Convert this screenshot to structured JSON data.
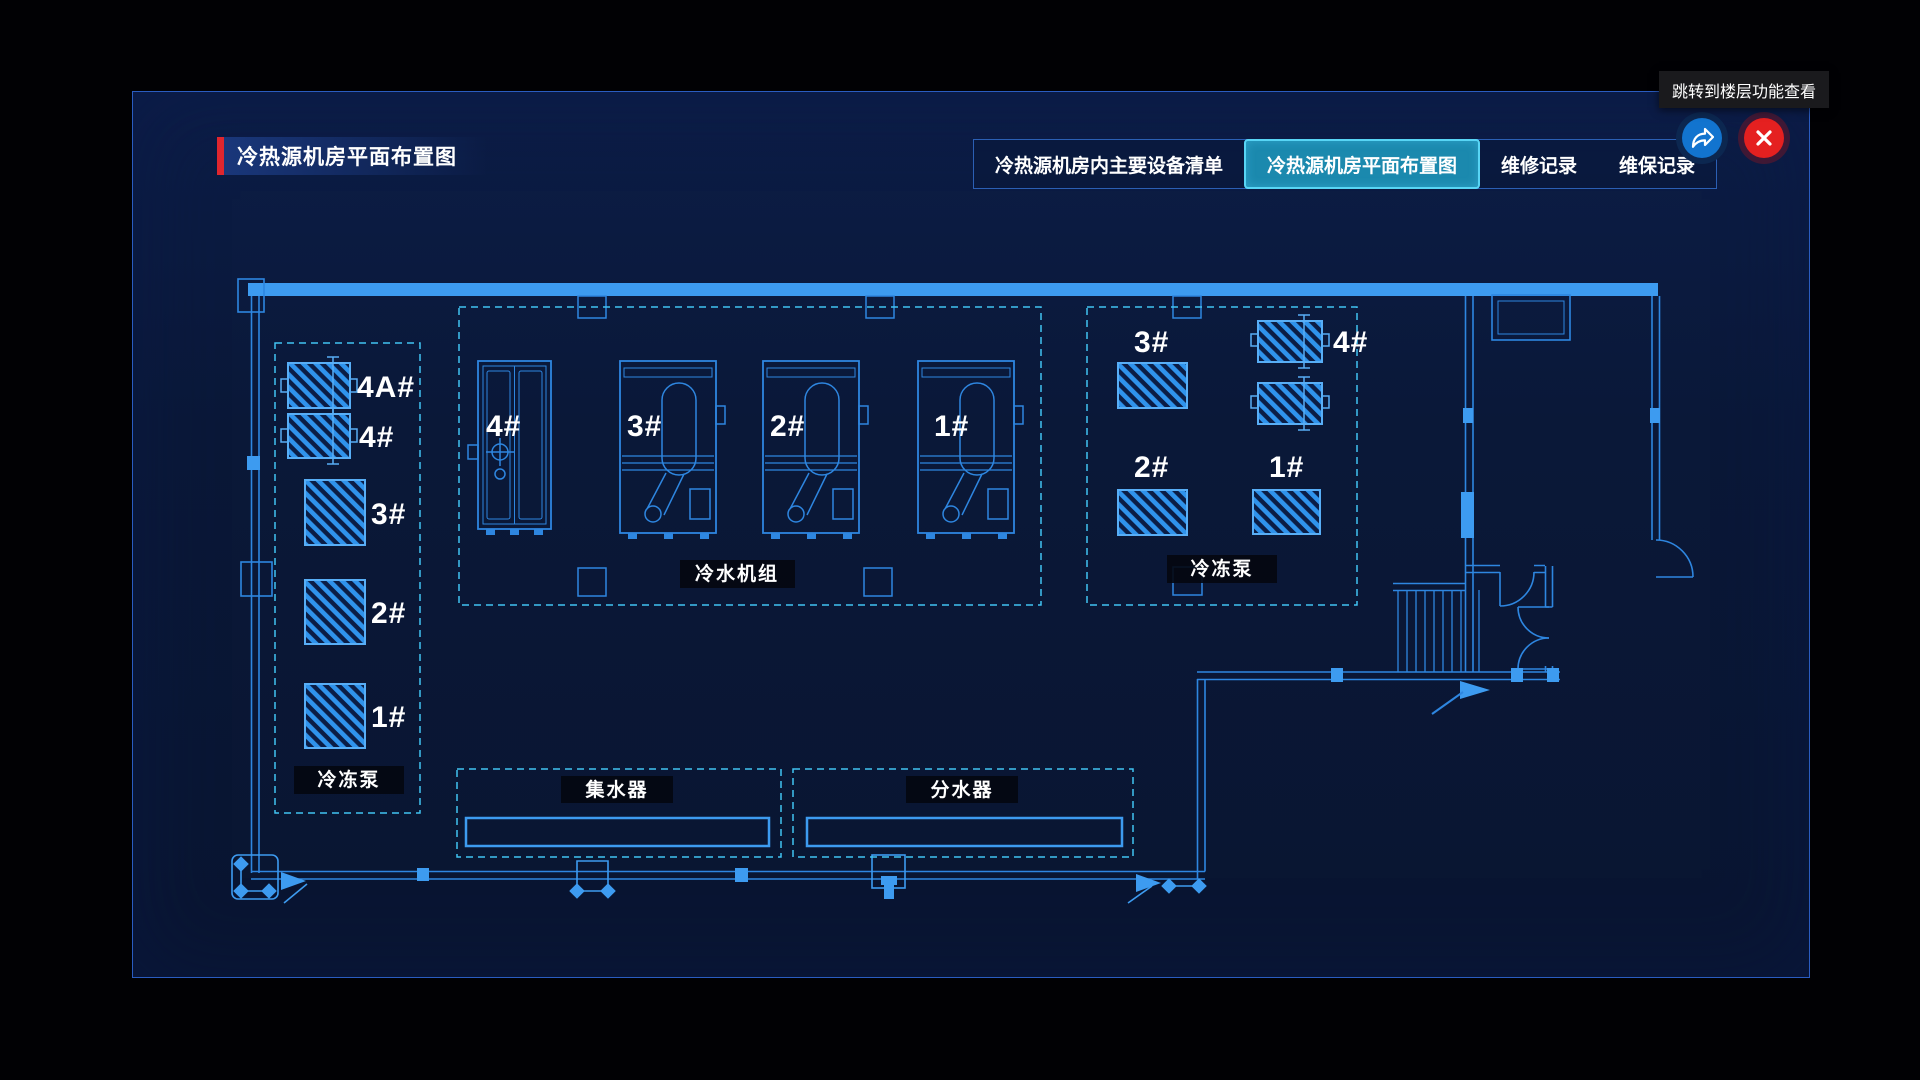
{
  "tooltip": {
    "text": "跳转到楼层功能查看"
  },
  "header": {
    "title": "冷热源机房平面布置图"
  },
  "tabs": {
    "items": [
      {
        "label": "冷热源机房内主要设备清单",
        "active": false
      },
      {
        "label": "冷热源机房平面布置图",
        "active": true
      },
      {
        "label": "维修记录",
        "active": false
      },
      {
        "label": "维保记录",
        "active": false
      }
    ]
  },
  "toolbar": {
    "share_icon": "share-arrow",
    "close_icon": "close-x"
  },
  "colors": {
    "accent_red": "#e0262e",
    "panel_border": "#2a5cc0",
    "active_tab": "#1b89ae",
    "active_tab_border": "#58d5f5",
    "line_blue": "#2e86e0",
    "bright_blue": "#3d9bf0",
    "dashed_cyan": "#41c3f2",
    "close_red": "#e52020",
    "share_blue": "#1274cf"
  },
  "floorplan": {
    "sections": [
      {
        "name": "left-pumps",
        "label": "冷冻泵",
        "units": [
          "4A#",
          "4#",
          "3#",
          "2#",
          "1#"
        ]
      },
      {
        "name": "chillers",
        "label": "冷水机组",
        "units": [
          "4#",
          "3#",
          "2#",
          "1#"
        ]
      },
      {
        "name": "right-pumps",
        "label": "冷冻泵",
        "units": [
          "3#",
          "4#",
          "2#",
          "1#"
        ]
      },
      {
        "name": "collector",
        "label": "集水器"
      },
      {
        "name": "distributor",
        "label": "分水器"
      }
    ]
  }
}
